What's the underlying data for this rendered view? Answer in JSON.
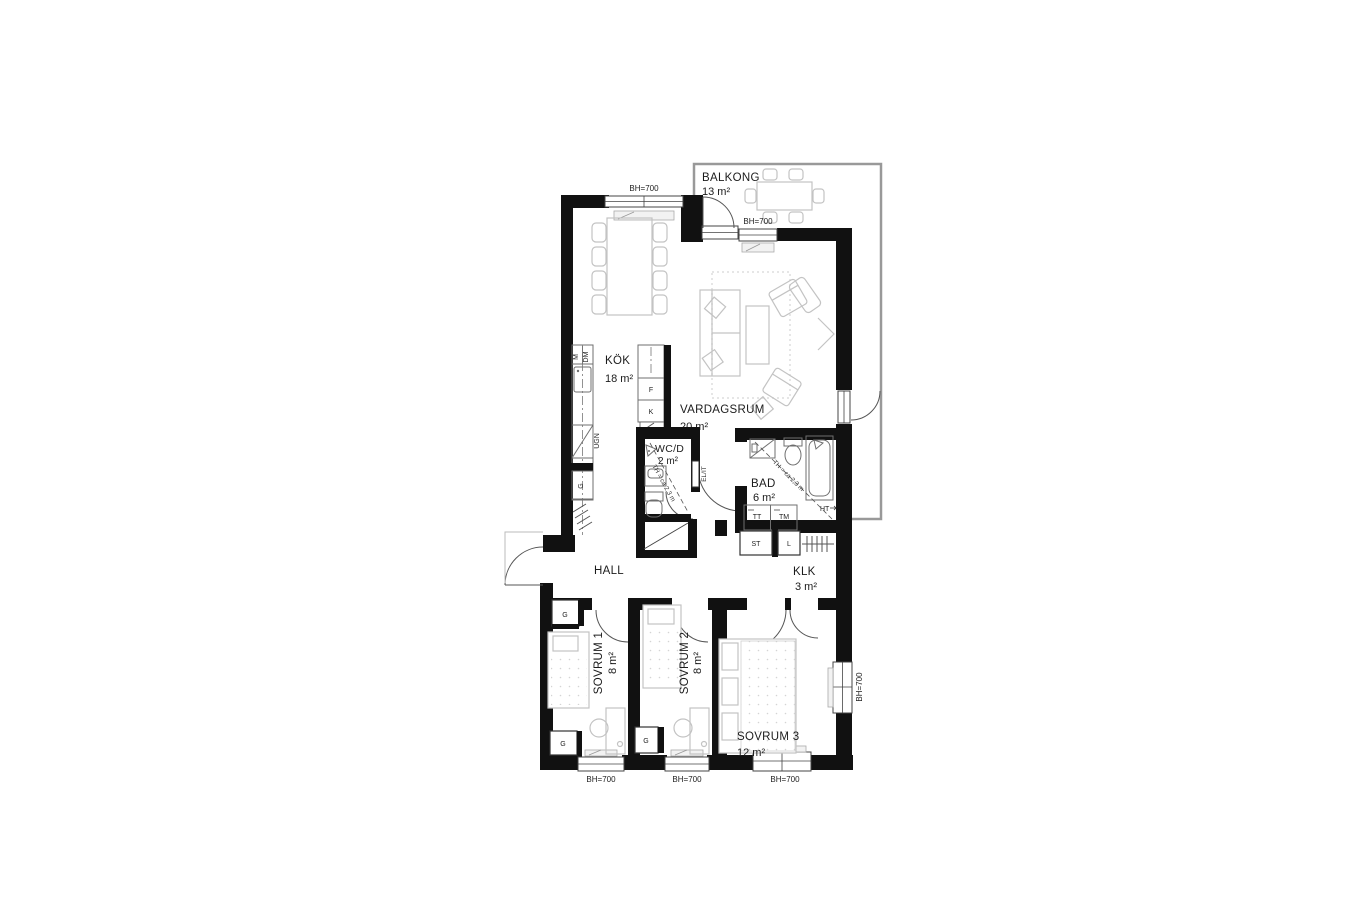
{
  "plan": {
    "rooms": {
      "balkong": {
        "name": "BALKONG",
        "area": "13 m²"
      },
      "kok": {
        "name": "KÖK",
        "area": "18 m²"
      },
      "vardagsrum": {
        "name": "VARDAGSRUM",
        "area": "20 m²"
      },
      "wcd": {
        "name": "WC/D",
        "area": "2 m²"
      },
      "bad": {
        "name": "BAD",
        "area": "6 m²"
      },
      "hall": {
        "name": "HALL"
      },
      "klk": {
        "name": "KLK",
        "area": "3 m²"
      },
      "sovrum1": {
        "name": "SOVRUM 1",
        "area": "8 m²"
      },
      "sovrum2": {
        "name": "SOVRUM 2",
        "area": "8 m²"
      },
      "sovrum3": {
        "name": "SOVRUM 3",
        "area": "12 m²"
      }
    },
    "labels": {
      "window_height": "BH=700",
      "ceiling_height": "TH = ca 2,3 m",
      "electrical": "EL/IT",
      "microwave": "M",
      "dishwasher": "DM",
      "oven": "UGN",
      "wardrobe": "G",
      "fridge": "F",
      "freezer": "K",
      "cleaning_closet": "ST",
      "linen_closet": "L",
      "dryer": "TT",
      "washer": "TM",
      "towel_rail": "HT"
    },
    "colors": {
      "wall": "#111111",
      "furniture": "#c3c3c3",
      "fixture": "#6f6f6f",
      "balcony_outline": "#999999"
    }
  }
}
